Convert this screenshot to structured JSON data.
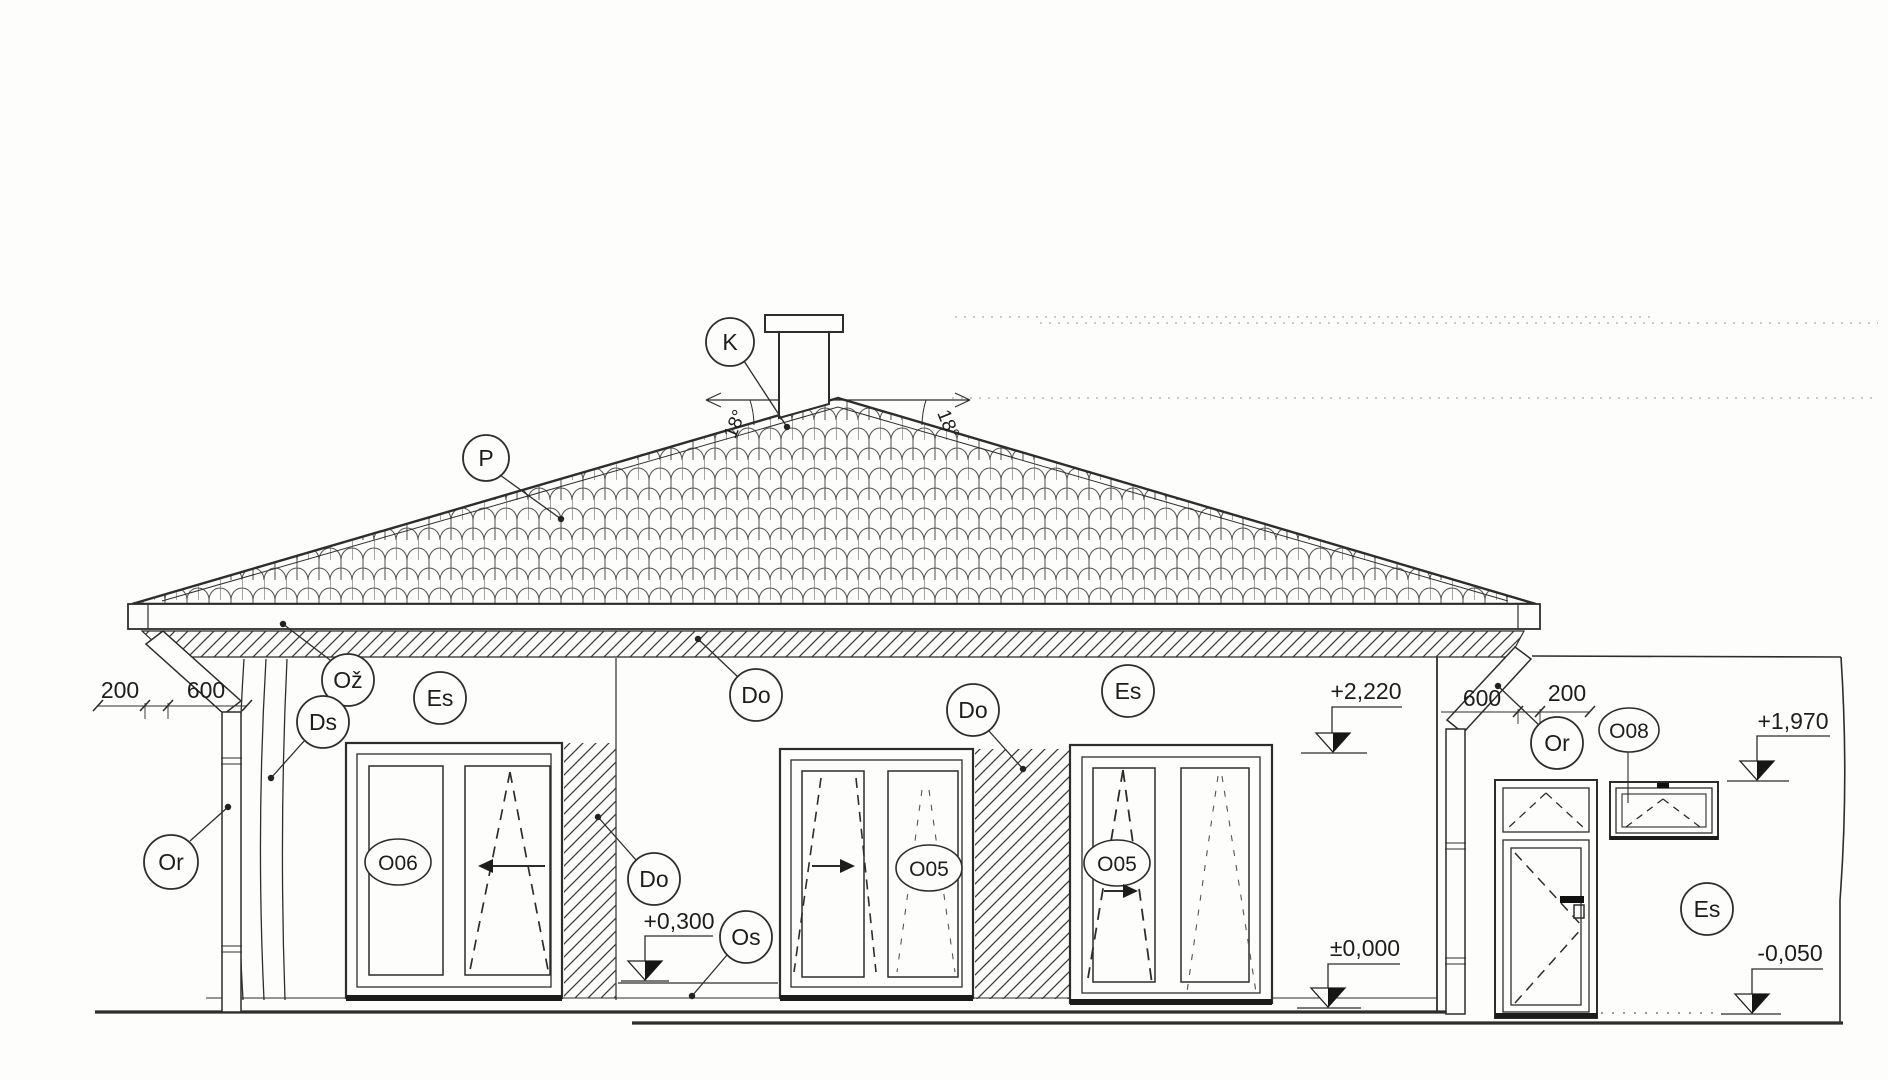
{
  "drawing": {
    "callouts": {
      "chimney": "K",
      "roof_covering": "P",
      "gutter": "Ož",
      "corner_downpipe": "Ds",
      "plaster": "Es",
      "cladding": "Do",
      "plinth": "Os",
      "rain_pipe": "Or"
    },
    "openings": {
      "left_window": "O06",
      "center_window": "O05",
      "right_window": "O05",
      "annex_window": "O08"
    },
    "roof": {
      "slope_left": "18°",
      "slope_right": "18°"
    },
    "dimensions": {
      "left_gutter_offset": "200",
      "left_eave_overhang": "600",
      "right_eave_overhang": "600",
      "right_gutter_offset": "200"
    },
    "levels": {
      "eave_height": "+2,220",
      "annex_eave_height": "+1,970",
      "entry_step": "+0,300",
      "ground_floor": "±0,000",
      "annex_floor": "-0,050"
    }
  }
}
